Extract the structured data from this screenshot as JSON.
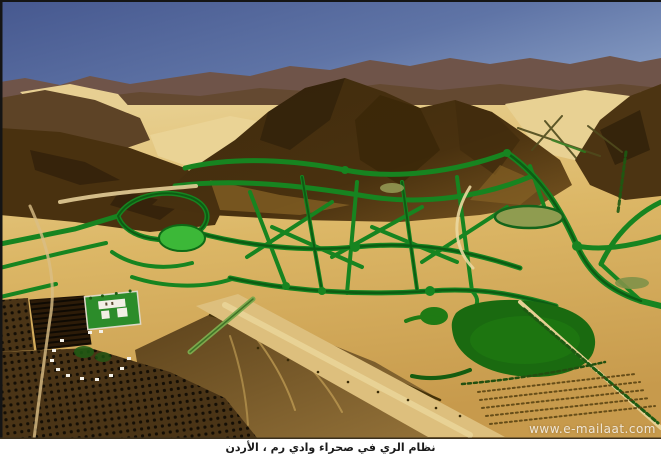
{
  "caption": {
    "text": "نظام الري في صحراء وادي رم ، الأردن"
  },
  "watermark": {
    "text": "www.e-mailaat.com"
  },
  "photo": {
    "description": "Aerial photograph of a web of green irrigation channels crossing golden desert sand between dark rocky mountains, Wadi Rum desert, Jordan",
    "colors": {
      "sky_left": "#46588f",
      "sky_right": "#8aa0c6",
      "distant_ridge": "#6f5449",
      "mountain_dark": "#49310f",
      "mountain_mid": "#7a5722",
      "sand_light": "#e9d294",
      "sand_mid": "#dcb766",
      "sand_deep": "#c79a4c",
      "channel_green": "#178420",
      "channel_dark_green": "#0d5c13",
      "field_bright_green": "#3cb838",
      "pond_dark_green": "#1a6a10",
      "pond_sage": "#8f9c50",
      "lawn_green": "#2c8c2a",
      "orchard_dark": "#4a3416"
    }
  }
}
